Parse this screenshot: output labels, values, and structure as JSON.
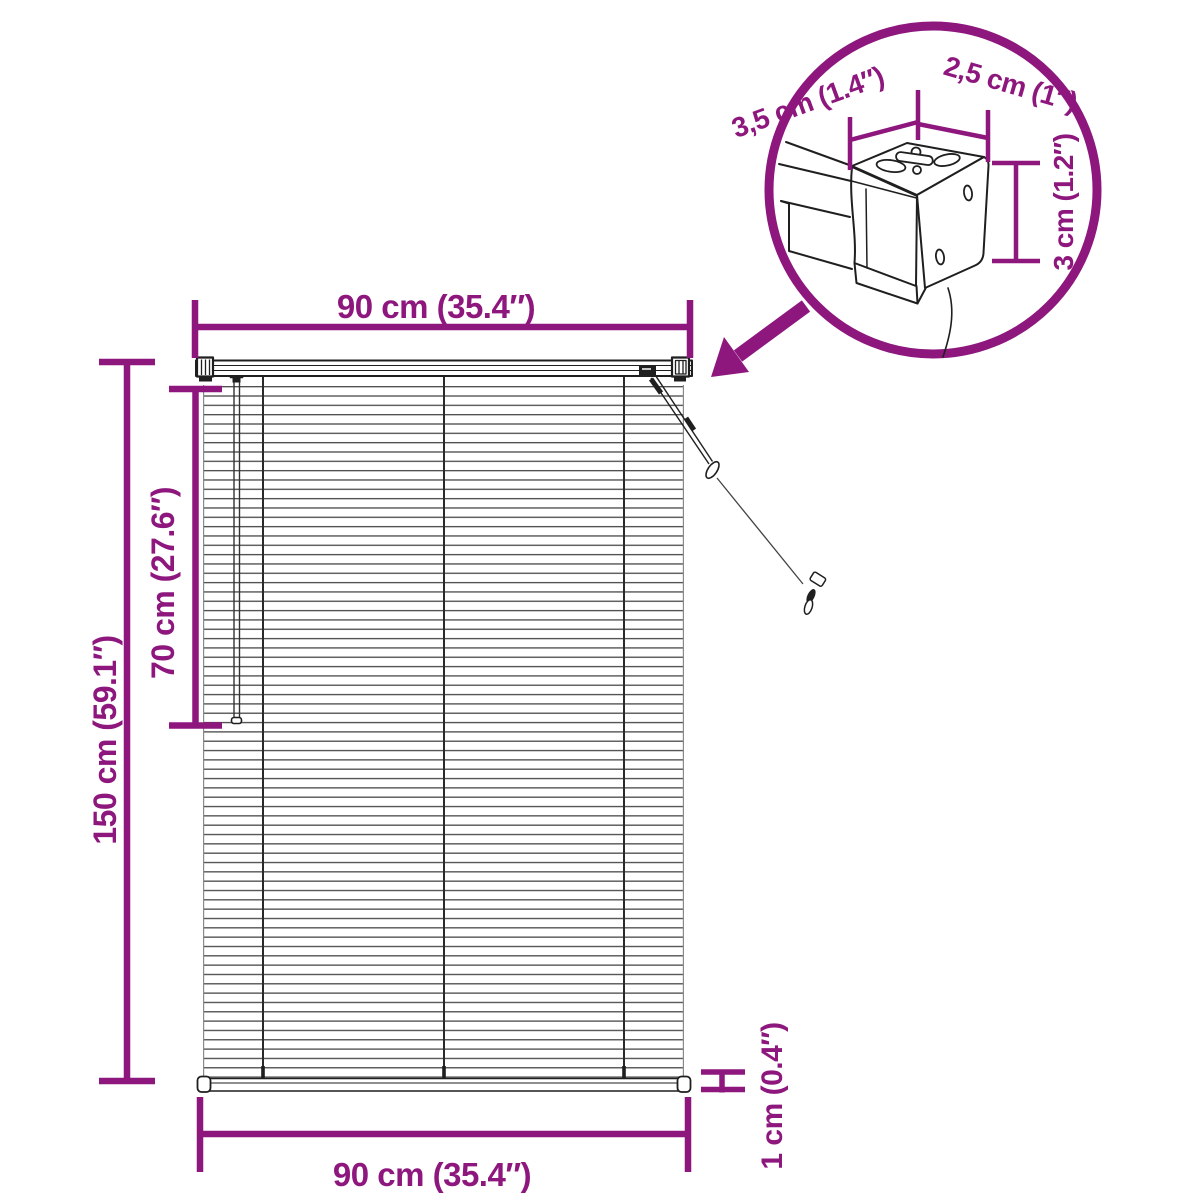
{
  "colors": {
    "accent": "#8E177E",
    "outline": "#1f1f1f",
    "slat_line": "#4f4f4f"
  },
  "labels": {
    "width_top": "90 cm (35.4″)",
    "height_total": "150 cm (59.1″)",
    "height_cord": "70 cm (27.6″)",
    "width_bottom": "90 cm (35.4″)",
    "rail_thickness": "1 cm (0.4″)"
  },
  "inset": {
    "bracket_depth": "3,5 cm (1.4″)",
    "bracket_width": "2,5 cm (1″)",
    "bracket_height": "3 cm (1.2″)"
  }
}
